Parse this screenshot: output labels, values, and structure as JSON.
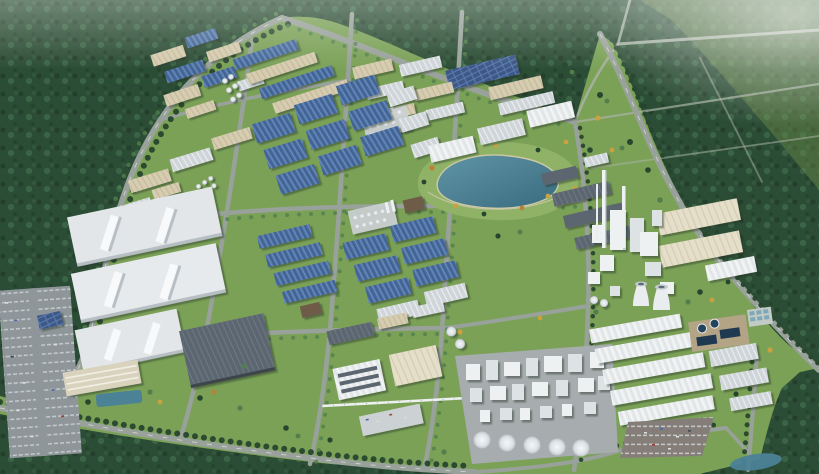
{
  "scene": {
    "type": "aerial-3d-architectural-rendering",
    "subject": "industrial park master plan",
    "description": "Bird's-eye 3D rendering of a large industrial park surrounded by dense forest: rows of blue-roofed and white-roofed factory halls, a central landscaped lake with autumn trees, three large white logistics warehouses, a cement/power plant with tall chimneys and cooling towers on the east, a chemical plant with white storage silos, south-east warehouse rows with water-treatment basins, surface parking lots and a tree-lined road grid.",
    "landmarks": [
      {
        "name": "forest-belt",
        "label": "Dense forest surrounding the park"
      },
      {
        "name": "northwest-factory-cluster",
        "label": "Blue-roofed factory rows (north-west)"
      },
      {
        "name": "north-factory-cluster",
        "label": "Tan and grey factory blocks (north)"
      },
      {
        "name": "big-blue-halls",
        "label": "Large steel-blue production halls"
      },
      {
        "name": "central-lake",
        "label": "Landscaped lake with autumn trees"
      },
      {
        "name": "west-warehouses",
        "label": "Three large white logistics warehouses"
      },
      {
        "name": "dark-warehouse",
        "label": "Dark grey warehouse"
      },
      {
        "name": "center-process-cluster",
        "label": "Mid-rise process buildings and tank rows"
      },
      {
        "name": "cement-plant",
        "label": "Plant with chimneys and cooling towers"
      },
      {
        "name": "silo-plant",
        "label": "Chemical plant with storage silos"
      },
      {
        "name": "southeast-warehouses",
        "label": "White warehouse rows (south-east)"
      },
      {
        "name": "water-treatment",
        "label": "Water treatment basins"
      },
      {
        "name": "parking-lots",
        "label": "Surface parking lots with cars"
      },
      {
        "name": "road-network",
        "label": "Tree-lined road grid"
      },
      {
        "name": "pipe-rack",
        "label": "Overhead pipe rack"
      }
    ]
  },
  "palette": {
    "forest": "#2c4d35",
    "forest-dot": "#223d2a",
    "forest-hi": "#3d6848",
    "meadow": "#7ba157",
    "meadow-hi": "#8fb267",
    "road": "#99a19b",
    "track": "#a9b2a5",
    "tree": "#27462e",
    "tree-light": "#517e4c",
    "tree-yellow": "#c9a23f",
    "tree-orange": "#bd8136",
    "roof-blue": "#4a6da0",
    "roof-blue-light": "#6e90c0",
    "roof-blue-dark": "#35517c",
    "solar-panel": "#3c5988",
    "roof-white": "#e9eced",
    "roof-white-bright": "#f7f9fa",
    "roof-gray": "#cfd5d9",
    "roof-slate": "#5b6670",
    "roof-tan": "#d6ccb1",
    "roof-tan-dark": "#c2b694",
    "roof-cream": "#e5dec9",
    "lake-deep": "#3a6b80",
    "lake-shallow": "#5f95a5",
    "pool": "#1e3950",
    "pond": "#4b8296",
    "asphalt": "#8f969a",
    "lot-brown": "#857e78",
    "concrete": "#a7acaf",
    "structure-white": "#eef1f2",
    "wall-shadow": "#b7bec4"
  }
}
